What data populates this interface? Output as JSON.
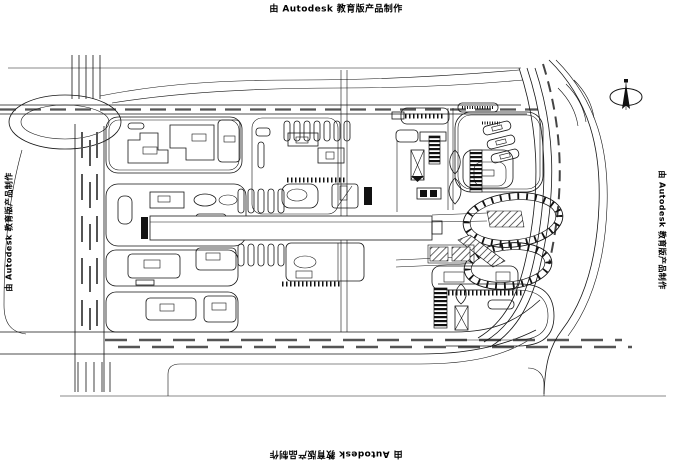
{
  "sheet": {
    "background": "#ffffff",
    "ink": "#151515"
  },
  "watermarks": {
    "top": "由 Autodesk 教育版产品制作",
    "bottom": "由 Autodesk 教育版产品制作",
    "left": "由 Autodesk 教育版产品制作",
    "right": "由 Autodesk 教育版产品制作"
  },
  "icons": {
    "north_arrow": "north-arrow"
  }
}
